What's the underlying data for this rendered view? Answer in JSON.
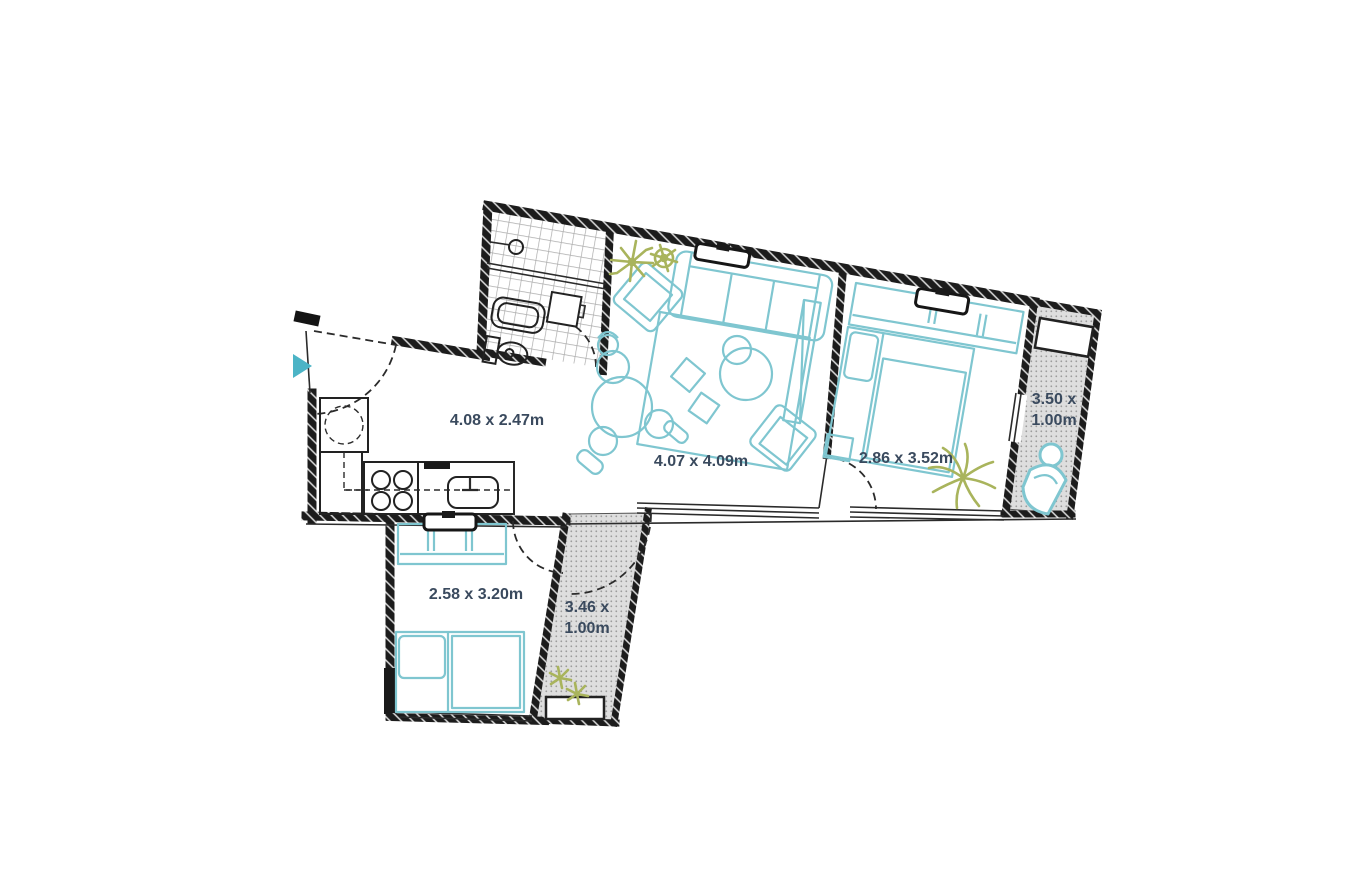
{
  "page": {
    "kind": "apartment-floor-plan",
    "background": "#ffffff"
  },
  "colors": {
    "furniture": "#7fc6d0",
    "accent": "#4cb4c6",
    "plant": "#a9b45c",
    "label": "#3a4a5e",
    "wall": "#1a1a1a",
    "balcony-fill": "#dedede",
    "balcony-dot": "#9b9b9b",
    "tile-line": "#ababab"
  },
  "icons": {
    "entrance_arrow": "right-pointing-triangle"
  },
  "rooms": {
    "hall_kitchen": {
      "name": "hall-kitchen",
      "dims": "4.08 x 2.47m"
    },
    "living_room": {
      "name": "living-room",
      "dims": "4.07 x 4.09m"
    },
    "bedroom_main": {
      "name": "bedroom-main",
      "dims": "2.86 x 3.52m"
    },
    "balcony_right": {
      "name": "balcony-right",
      "dims_line1": "3.50 x",
      "dims_line2": "1.00m"
    },
    "bedroom_second": {
      "name": "bedroom-second",
      "dims": "2.58 x 3.20m"
    },
    "balcony_bottom": {
      "name": "balcony-bottom",
      "dims_line1": "3.46 x",
      "dims_line2": "1.00m"
    }
  }
}
